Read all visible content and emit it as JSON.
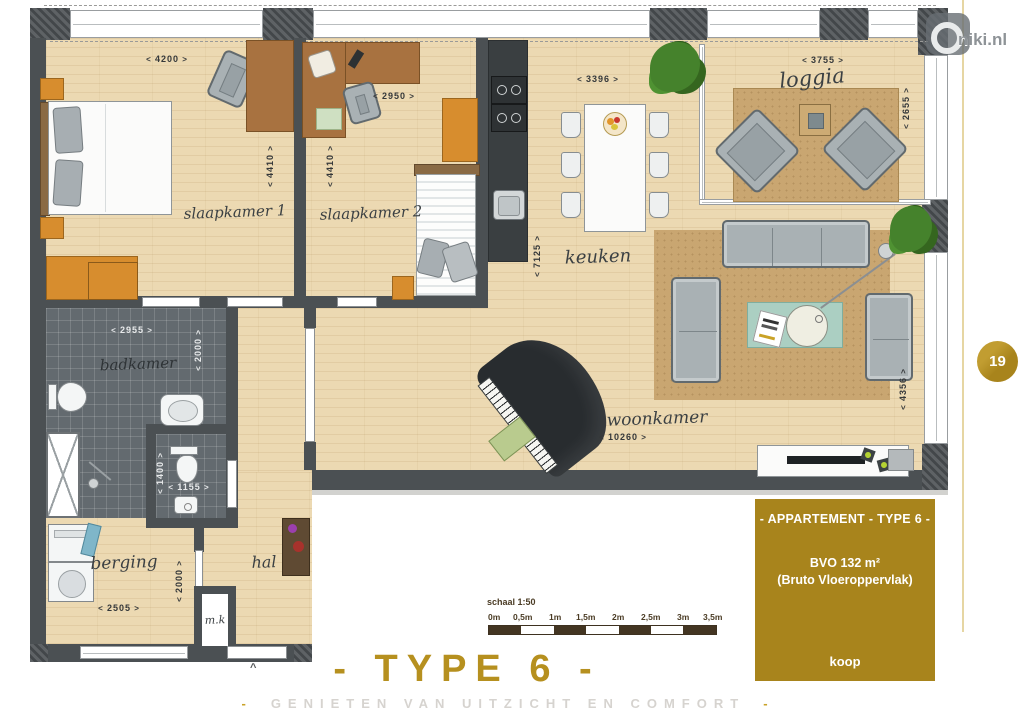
{
  "branding": {
    "logo_text": "niki.nl",
    "page_number": "19"
  },
  "labels": {
    "slaapkamer1": "slaapkamer 1",
    "slaapkamer2": "slaapkamer 2",
    "keuken": "keuken",
    "loggia": "loggia",
    "woonkamer": "woonkamer",
    "badkamer": "badkamer",
    "berging": "berging",
    "hal": "hal",
    "meterkast": "m.k"
  },
  "dims": {
    "sl1_w": "4200",
    "sl1_h": "4410",
    "sl2_w": "2950",
    "sl2_h": "4410",
    "keuken_w": "3396",
    "keuken_h": "7125",
    "loggia_w": "3755",
    "loggia_h": "2655",
    "badkamer_w": "2955",
    "badkamer_h": "2000",
    "wc_w": "1155",
    "wc_h": "1400",
    "berging_w": "2505",
    "berging_h": "2000",
    "woonkamer_w": "10260",
    "woonkamer_h": "4356"
  },
  "entrance_marker": "^",
  "info_box": {
    "title": "- APPARTEMENT -  TYPE 6 -",
    "area": "BVO 132 m²",
    "area_note": "(Bruto Vloeroppervlak)",
    "tenure": "koop"
  },
  "scale_bar": {
    "label": "schaal 1:50",
    "ticks": [
      "0m",
      "0,5m",
      "1m",
      "1,5m",
      "2m",
      "2,5m",
      "3m",
      "3,5m"
    ]
  },
  "footer": {
    "title": "- TYPE 6 -",
    "tagline": "GENIETEN VAN UITZICHT EN COMFORT",
    "dash": "-"
  },
  "colors": {
    "gold": "#a8841c",
    "gold_text": "#b6901f",
    "wall": "#4b5053",
    "wood": "#ecd9b2",
    "tile": "#636a6f",
    "rug": "#c9a671"
  }
}
